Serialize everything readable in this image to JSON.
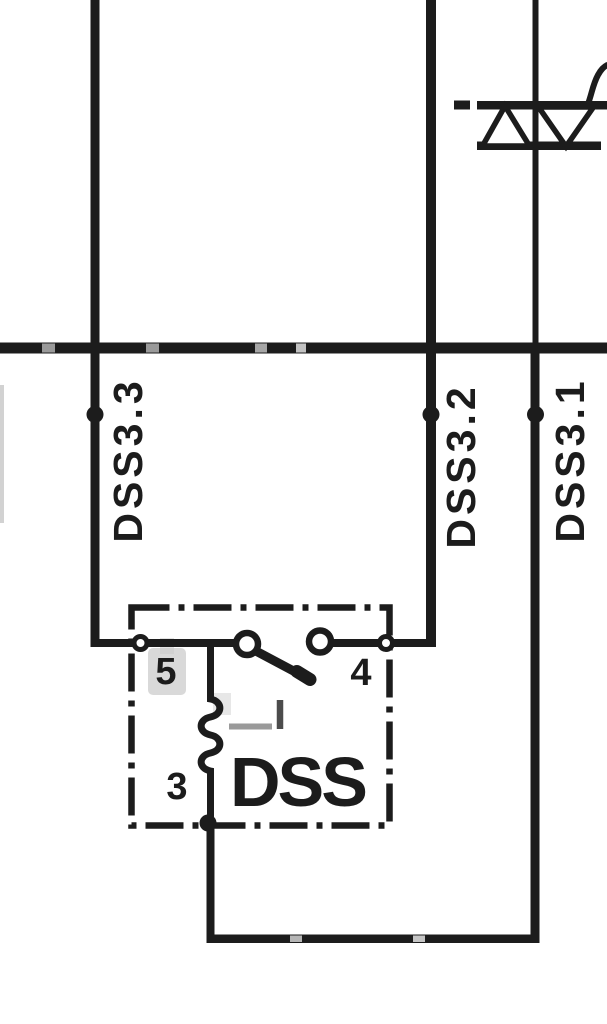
{
  "diagram": {
    "wire_labels": [
      "DSS3.3",
      "DSS3.2",
      "DSS3.1"
    ],
    "component": {
      "name": "DSS"
    },
    "terminals": {
      "left": "5",
      "right": "4",
      "bottom": "3"
    },
    "symbols": [
      "triac-icon",
      "power-bus-line",
      "junction-dot",
      "switch-contact-icon",
      "resistor-coil-icon",
      "dash-dot-enclosure"
    ],
    "colors": {
      "ink": "#1c1c1c",
      "background": "#ffffff",
      "scan_artifact": "#9a9a9a"
    }
  }
}
